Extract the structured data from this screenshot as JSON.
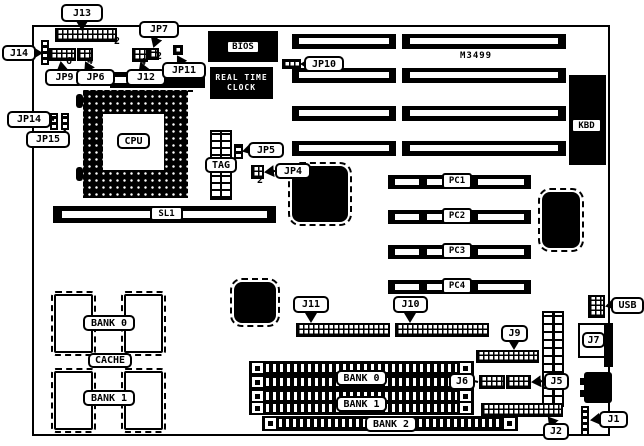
{
  "diagram": {
    "connector_labels": {
      "j13": "J13",
      "jp7": "JP7",
      "j14": "J14",
      "jp9": "JP9",
      "jp6": "JP6",
      "j12": "J12",
      "jp11": "JP11",
      "jp14": "JP14",
      "jp15": "JP15",
      "jp10": "JP10",
      "jp5": "JP5",
      "jp4": "JP4",
      "j11": "J11",
      "j10": "J10",
      "j9": "J9",
      "j6": "J6",
      "j5": "J5",
      "j2": "J2",
      "j1": "J1",
      "j7": "J7",
      "usb": "USB",
      "kbd": "KBD"
    },
    "chip_labels": {
      "bios": "BIOS",
      "rtc_line1": "REAL TIME",
      "rtc_line2": "CLOCK",
      "cpu": "CPU",
      "tag": "TAG",
      "model": "M3499",
      "p_mark": "P"
    },
    "slot_labels": {
      "sl1": "SL1",
      "pci": [
        "PC1",
        "PC2",
        "PC3",
        "PC4"
      ]
    },
    "memory_labels": {
      "cache_bank0": "BANK 0",
      "cache": "CACHE",
      "cache_bank1": "BANK 1",
      "simm_bank0": "BANK 0",
      "simm_bank1": "BANK 1",
      "simm_bank2": "BANK 2"
    },
    "pin_numbers": {
      "j13": "2",
      "jp9": "6",
      "jp6": "4",
      "j12": "4",
      "jp7": "2",
      "jp4": "2"
    }
  }
}
